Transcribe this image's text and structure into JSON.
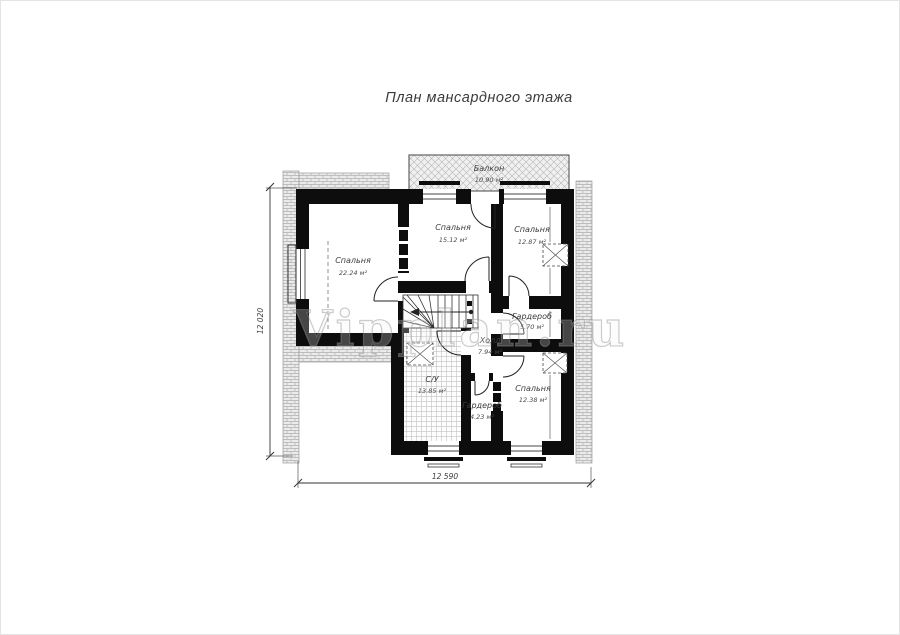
{
  "page": {
    "title": "План мансардного этажа",
    "watermark": "Vipplan.ru"
  },
  "rooms": [
    {
      "name": "Спальня",
      "area": "22.24 м²"
    },
    {
      "name": "Спальня",
      "area": "15.12 м²"
    },
    {
      "name": "Спальня",
      "area": "12.87 м²"
    },
    {
      "name": "Балкон",
      "area": "10.90 м²"
    },
    {
      "name": "Холл",
      "area": "7.94 м²"
    },
    {
      "name": "Гардероб",
      "area": "5.70 м²"
    },
    {
      "name": "Спальня",
      "area": "12.38 м²"
    },
    {
      "name": "Гардероб",
      "area": "4.23 м²"
    },
    {
      "name": "С/У",
      "area": "13.85 м²"
    }
  ],
  "dimensions": {
    "bottom": "12 590",
    "left": "12 020"
  },
  "colors": {
    "wall": "#0d0d0d",
    "hatch_fill": "#ebebeb",
    "hatch_line": "#b0b0b0",
    "text": "#3d3d3d"
  }
}
